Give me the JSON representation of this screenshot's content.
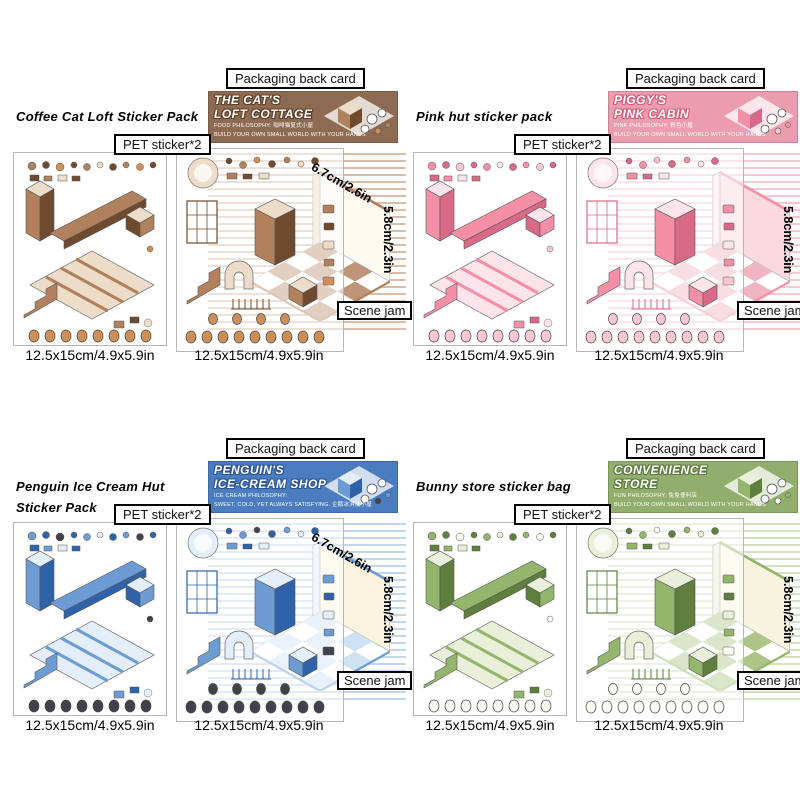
{
  "canvas": {
    "width": 800,
    "height": 800,
    "background": "#ffffff"
  },
  "quadrants": [
    {
      "name": "coffee-cat-loft",
      "title_line1": "Coffee Cat Loft Sticker Pack",
      "title_line2": "",
      "packaging_label": "Packaging back card",
      "pet_label": "PET sticker*2",
      "banner": {
        "title1": "THE CAT'S",
        "title2": "LOFT COTTAGE",
        "sub1": "FOOD PHILOSOPHY: 咖啡猫复式小屋",
        "sub2": "BUILD YOUR OWN SMALL WORLD WITH YOUR HANDS"
      },
      "scene_depth": "6.7cm/2.6in",
      "scene_height": "5.8cm/2.3in",
      "scene_label": "Scene jam",
      "sheet1_size": "12.5x15cm/4.9x5.9in",
      "sheet2_size": "12.5x15cm/4.9x5.9in",
      "colors": {
        "accent": "#8d6b52",
        "b_outline": "#5f4128",
        "stripe": "#d8bda9",
        "wall": "#fdf9f0",
        "floor": "#c09478",
        "item_a": "#b1805c",
        "item_b": "#6f4a2f",
        "item_c": "#ecdcc8",
        "mascot": "#cd8f55"
      }
    },
    {
      "name": "pink-hut",
      "title_line1": "Pink hut sticker pack",
      "title_line2": "",
      "packaging_label": "Packaging back card",
      "pet_label": "PET sticker*2",
      "banner": {
        "title1": "PIGGY'S",
        "title2": "PINK CABIN",
        "sub1": "PINK PHILOSOPHY: 粉色小屋",
        "sub2": "BUILD YOUR OWN SMALL WORLD WITH YOUR HANDS"
      },
      "scene_depth": "",
      "scene_height": "5.8cm/2.3in",
      "scene_label": "Scene jam",
      "sheet1_size": "12.5x15cm/4.9x5.9in",
      "sheet2_size": "12.5x15cm/4.9x5.9in",
      "colors": {
        "accent": "#eb9cae",
        "b_outline": "#d3617e",
        "stripe": "#f6c9d2",
        "wall": "#f9d9de",
        "floor": "#f0b4c2",
        "item_a": "#f48fa7",
        "item_b": "#d96a87",
        "item_c": "#fce4ea",
        "mascot": "#f9c7d2"
      }
    },
    {
      "name": "penguin-ice-cream-hut",
      "title_line1": "Penguin Ice Cream Hut",
      "title_line2": "Sticker Pack",
      "packaging_label": "Packaging back card",
      "pet_label": "PET sticker*2",
      "banner": {
        "title1": "PENGUIN'S",
        "title2": "ICE-CREAM SHOP",
        "sub1": "ICE CREAM PHILOSOPHY:",
        "sub2": "SWEET, COLD, YET ALWAYS SATISFYING. 企鹅冰淇凌小屋"
      },
      "scene_depth": "6.7cm/2.6in",
      "scene_height": "5.8cm/2.3in",
      "scene_label": "Scene jam",
      "sheet1_size": "12.5x15cm/4.9x5.9in",
      "sheet2_size": "12.5x15cm/4.9x5.9in",
      "colors": {
        "accent": "#4b7cc0",
        "b_outline": "#2c5694",
        "stripe": "#c2d6eb",
        "wall": "#fbf3e0",
        "floor": "#cfe1f3",
        "item_a": "#6d9cd4",
        "item_b": "#2f62a8",
        "item_c": "#e3eefa",
        "mascot": "#40414b"
      }
    },
    {
      "name": "bunny-store",
      "title_line1": "Bunny store sticker bag",
      "title_line2": "",
      "packaging_label": "Packaging back card",
      "pet_label": "PET sticker*2",
      "banner": {
        "title1": "CONVENIENCE",
        "title2": "STORE",
        "sub1": "FUN PHILOSOPHY: 兔兔便利店",
        "sub2": "BUILD YOUR OWN SMALL WORLD WITH YOUR HANDS"
      },
      "scene_depth": "",
      "scene_height": "5.8cm/2.3in",
      "scene_label": "Scene jam",
      "sheet1_size": "12.5x15cm/4.9x5.9in",
      "sheet2_size": "12.5x15cm/4.9x5.9in",
      "colors": {
        "accent": "#92ae6d",
        "b_outline": "#5e7c41",
        "stripe": "#d4e0c2",
        "wall": "#f8f3df",
        "floor": "#aec587",
        "item_a": "#94b56c",
        "item_b": "#5e7f3e",
        "item_c": "#e9efd8",
        "mascot": "#fbfaf3"
      }
    }
  ]
}
